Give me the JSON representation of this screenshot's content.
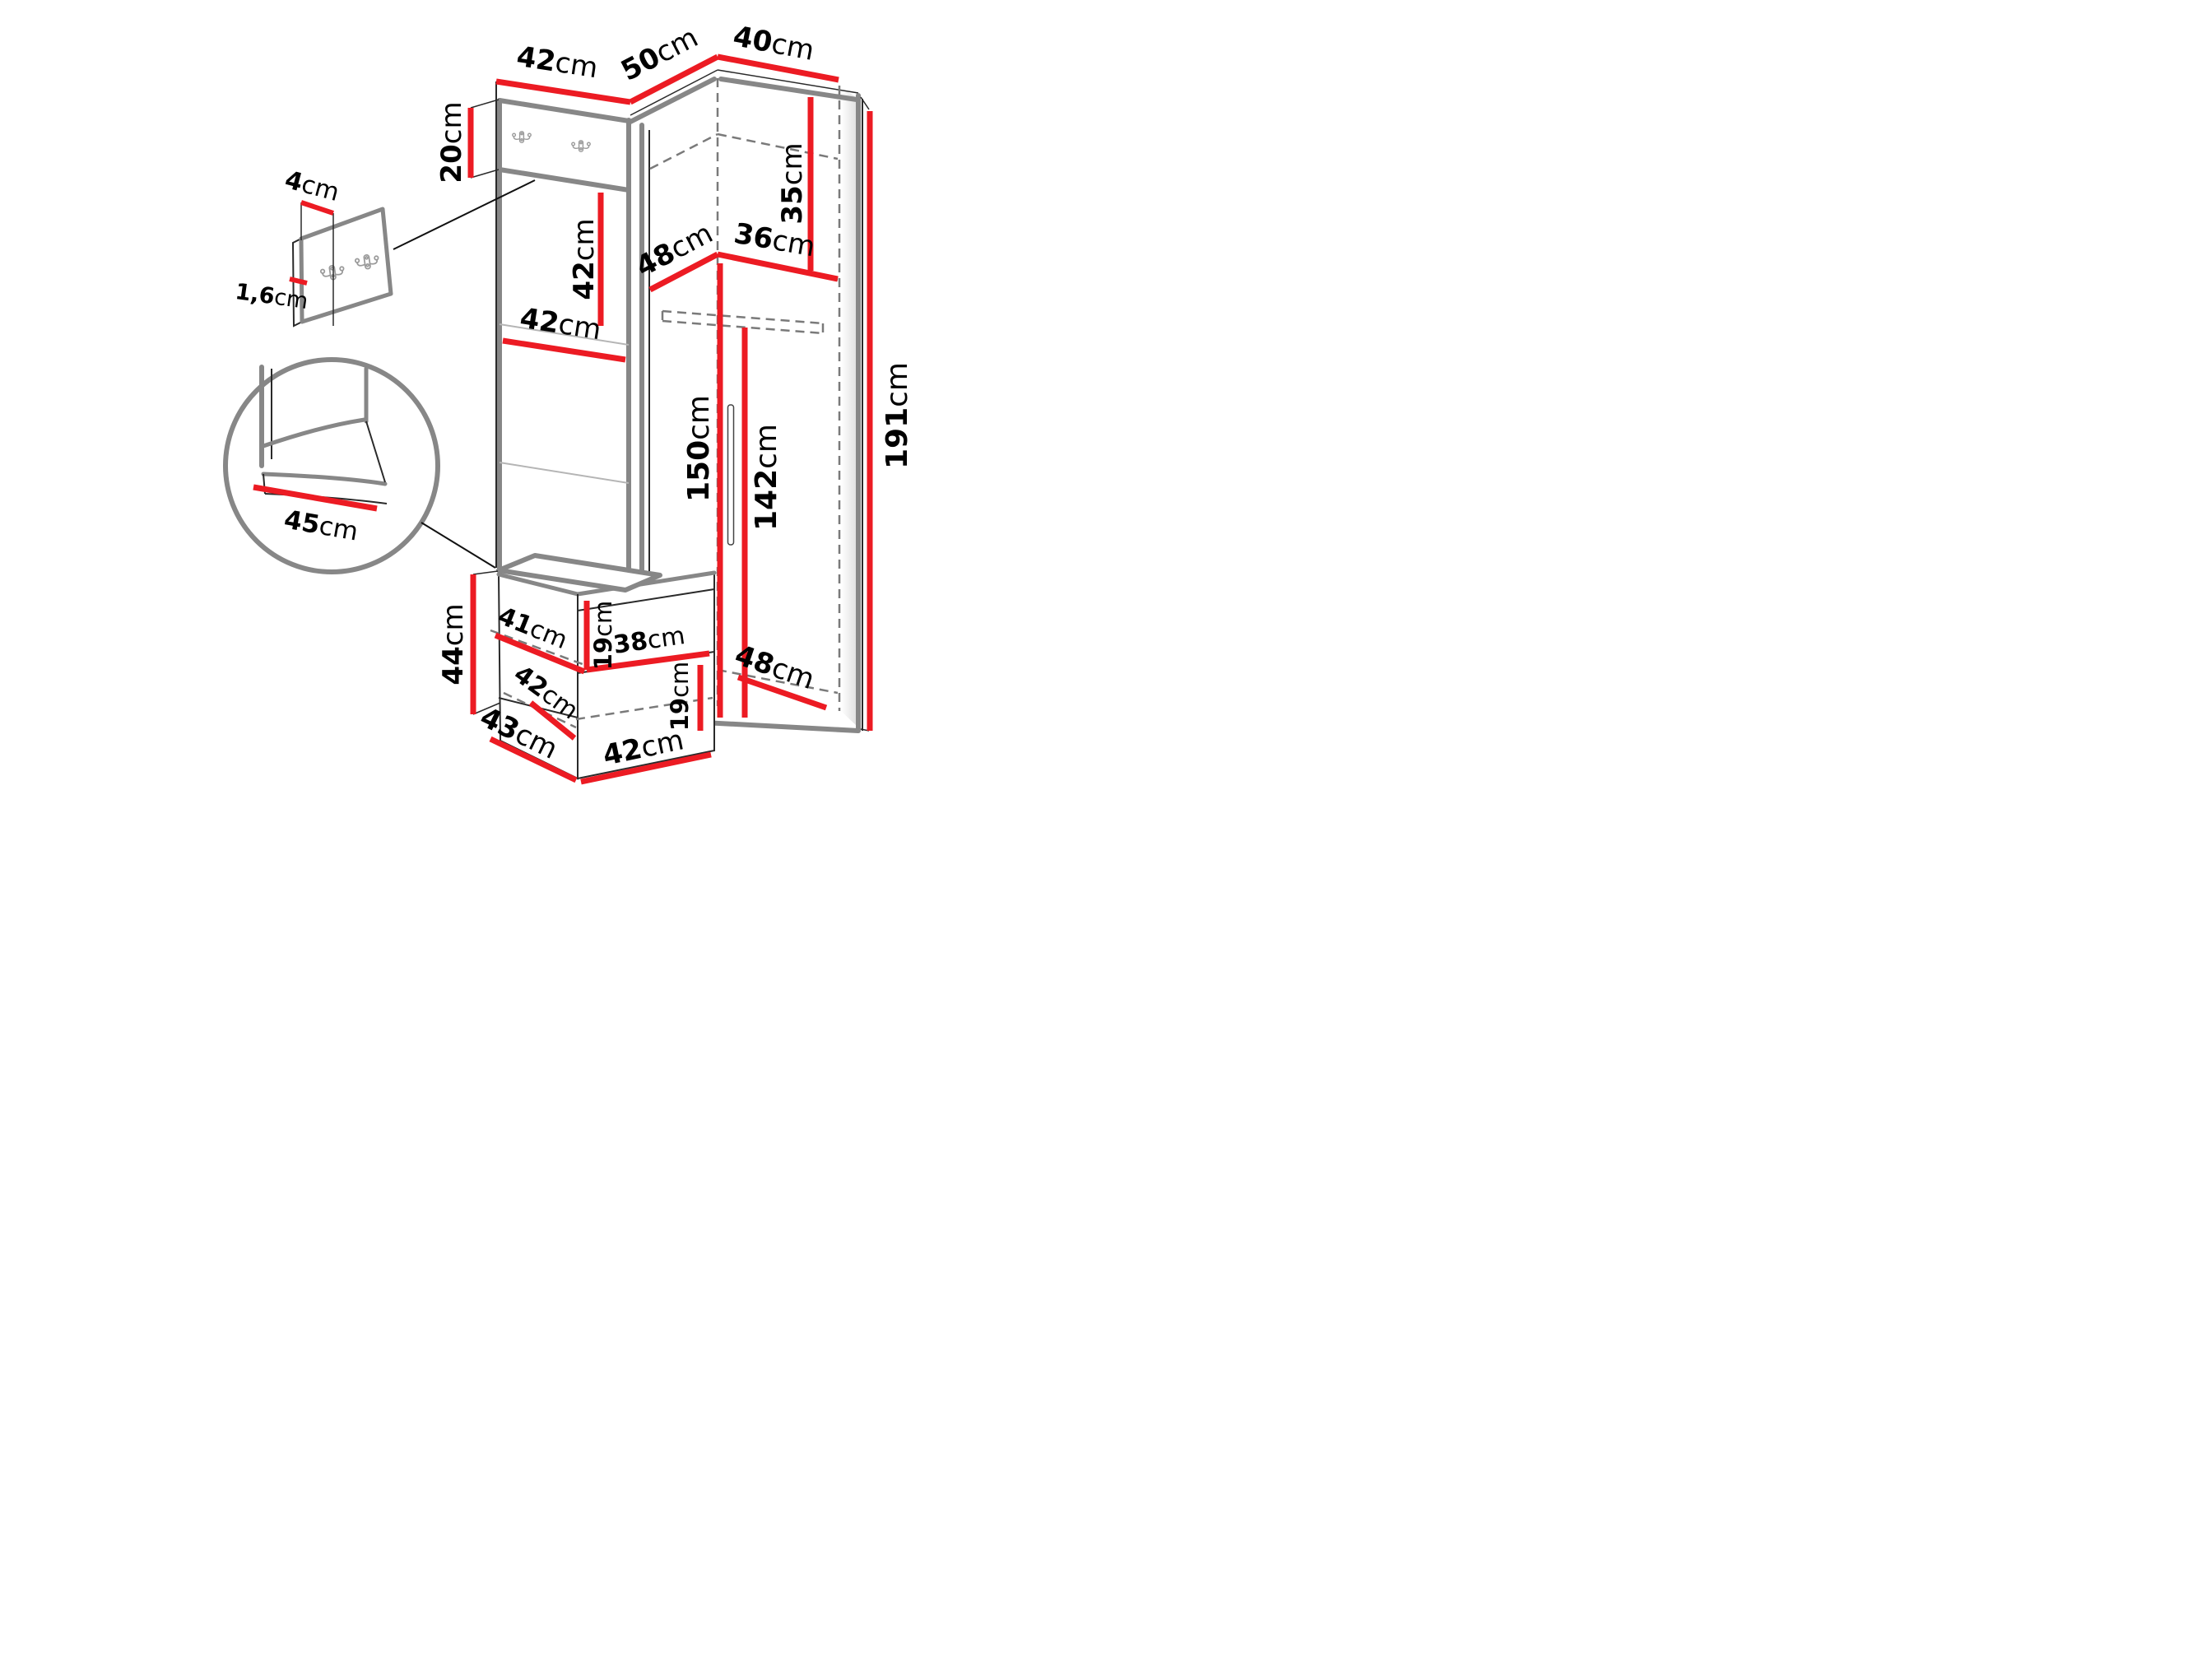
{
  "diagram": {
    "type": "furniture-dimension-diagram",
    "unit": "cm",
    "colors": {
      "dimension_line": "#ec1b23",
      "edge_heavy": "#878787",
      "edge_thin": "#2a2a2a",
      "hidden_line": "#7a7a7a",
      "background": "#ffffff",
      "label_text": "#000000"
    },
    "icons": {
      "coat_hook": "double-coat-hook-icon"
    },
    "dimensions": {
      "top_panel_width": {
        "value": "42",
        "unit": "cm"
      },
      "top_left_section_width": {
        "value": "50",
        "unit": "cm"
      },
      "top_right_section_width": {
        "value": "40",
        "unit": "cm"
      },
      "hook_panel_height": {
        "value": "20",
        "unit": "cm"
      },
      "detail_hook_depth": {
        "value": "4",
        "unit": "cm"
      },
      "detail_panel_thickness": {
        "value": "1,6",
        "unit": "cm"
      },
      "panel_segment_height": {
        "value": "42",
        "unit": "cm"
      },
      "panel_width": {
        "value": "42",
        "unit": "cm"
      },
      "niche_depth": {
        "value": "48",
        "unit": "cm"
      },
      "niche_width": {
        "value": "36",
        "unit": "cm"
      },
      "niche_height": {
        "value": "35",
        "unit": "cm"
      },
      "interior_height": {
        "value": "150",
        "unit": "cm"
      },
      "hanging_height": {
        "value": "142",
        "unit": "cm"
      },
      "total_height": {
        "value": "191",
        "unit": "cm"
      },
      "seat_depth": {
        "value": "45",
        "unit": "cm"
      },
      "bench_height": {
        "value": "44",
        "unit": "cm"
      },
      "bench_shelf_depth": {
        "value": "41",
        "unit": "cm"
      },
      "bench_shelf_opening_height": {
        "value": "19",
        "unit": "cm"
      },
      "bench_shelf_width": {
        "value": "38",
        "unit": "cm"
      },
      "bench_bottom_shelf_width": {
        "value": "42",
        "unit": "cm"
      },
      "bench_bottom_opening_height": {
        "value": "19",
        "unit": "cm"
      },
      "bench_depth": {
        "value": "43",
        "unit": "cm"
      },
      "bench_width": {
        "value": "42",
        "unit": "cm"
      },
      "wardrobe_bottom_depth": {
        "value": "48",
        "unit": "cm"
      }
    }
  }
}
